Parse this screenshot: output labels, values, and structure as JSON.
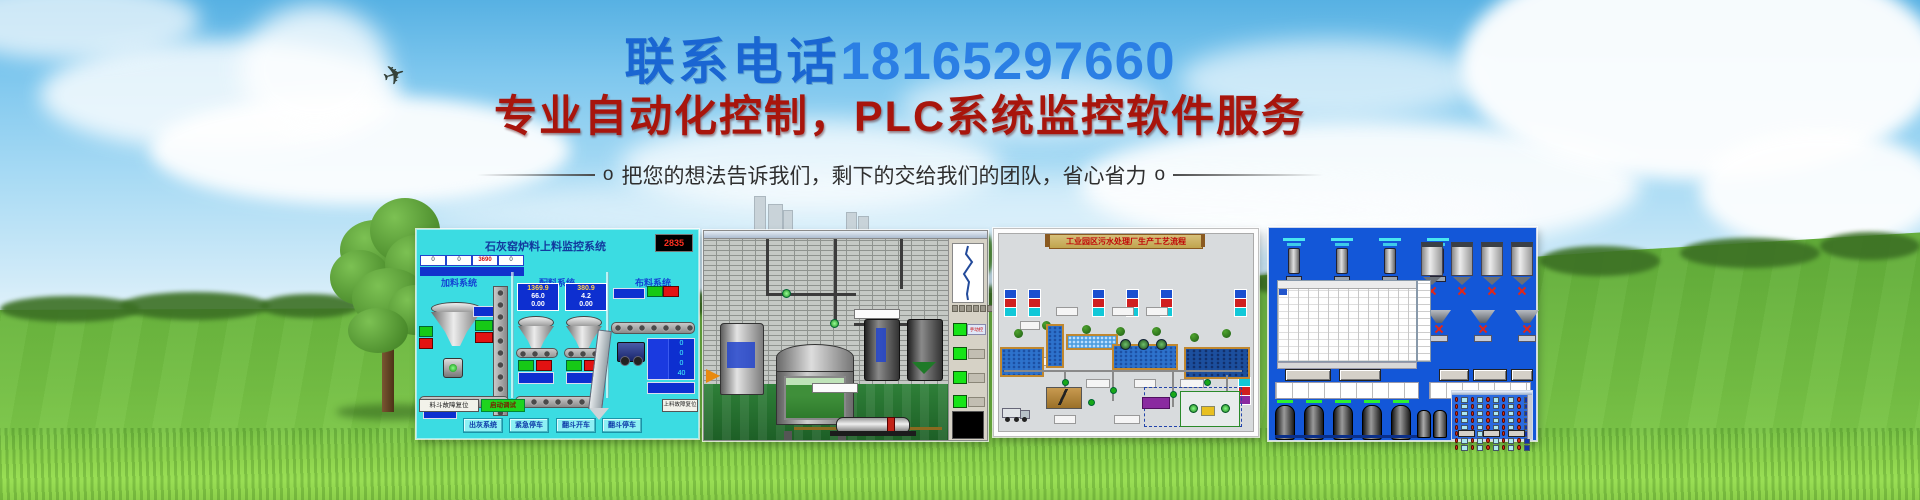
{
  "hero": {
    "phone_prefix": "联系电话",
    "phone_number": "18165297660",
    "headline": "专业自动化控制，PLC系统监控软件服务",
    "bullet_left": "o",
    "tagline": "把您的想法告诉我们，剩下的交给我们的团队，省心省力",
    "bullet_right": "o"
  },
  "colors": {
    "phone_blue": "#1a66d2",
    "phone_number_blue": "#2b7fe4",
    "headline_red": "#a8150c",
    "tagline_gray": "#2f2f2f",
    "sky_blue": "#7ec7ee",
    "grass_green": "#5aa434",
    "scada1_bg": "#3bdce2",
    "scada4_bg": "#1357d8"
  },
  "scada1": {
    "title": "石灰窑炉料上料监控系统",
    "clock": "2835",
    "section_feed": "加料系统",
    "section_batch": "配料系统",
    "section_dist": "布料系统",
    "strip_values": [
      "0",
      "0",
      "3690",
      "0"
    ],
    "hopperA": {
      "v1": "1369.9",
      "v2": "66.0",
      "v3": "0.00"
    },
    "hopperB": {
      "v1": "380.9",
      "v2": "4.2",
      "v3": "0.00"
    },
    "right_values": [
      "0",
      "0",
      "0",
      "40"
    ],
    "btn_hopper_reset": "料斗故障复位",
    "btn_start_debug": "启动调试",
    "btn_feed_fault": "上料故障复位",
    "btn_ash_system": "出灰系统",
    "btn_emergency_stop": "紧急停车",
    "btn_tipper_start": "翻斗开车",
    "btn_tipper_stop": "翻斗停车"
  },
  "scada2": {
    "label_manual": "手动控制"
  },
  "scada3": {
    "title": "工业园区污水处理厂生产工艺流程"
  }
}
